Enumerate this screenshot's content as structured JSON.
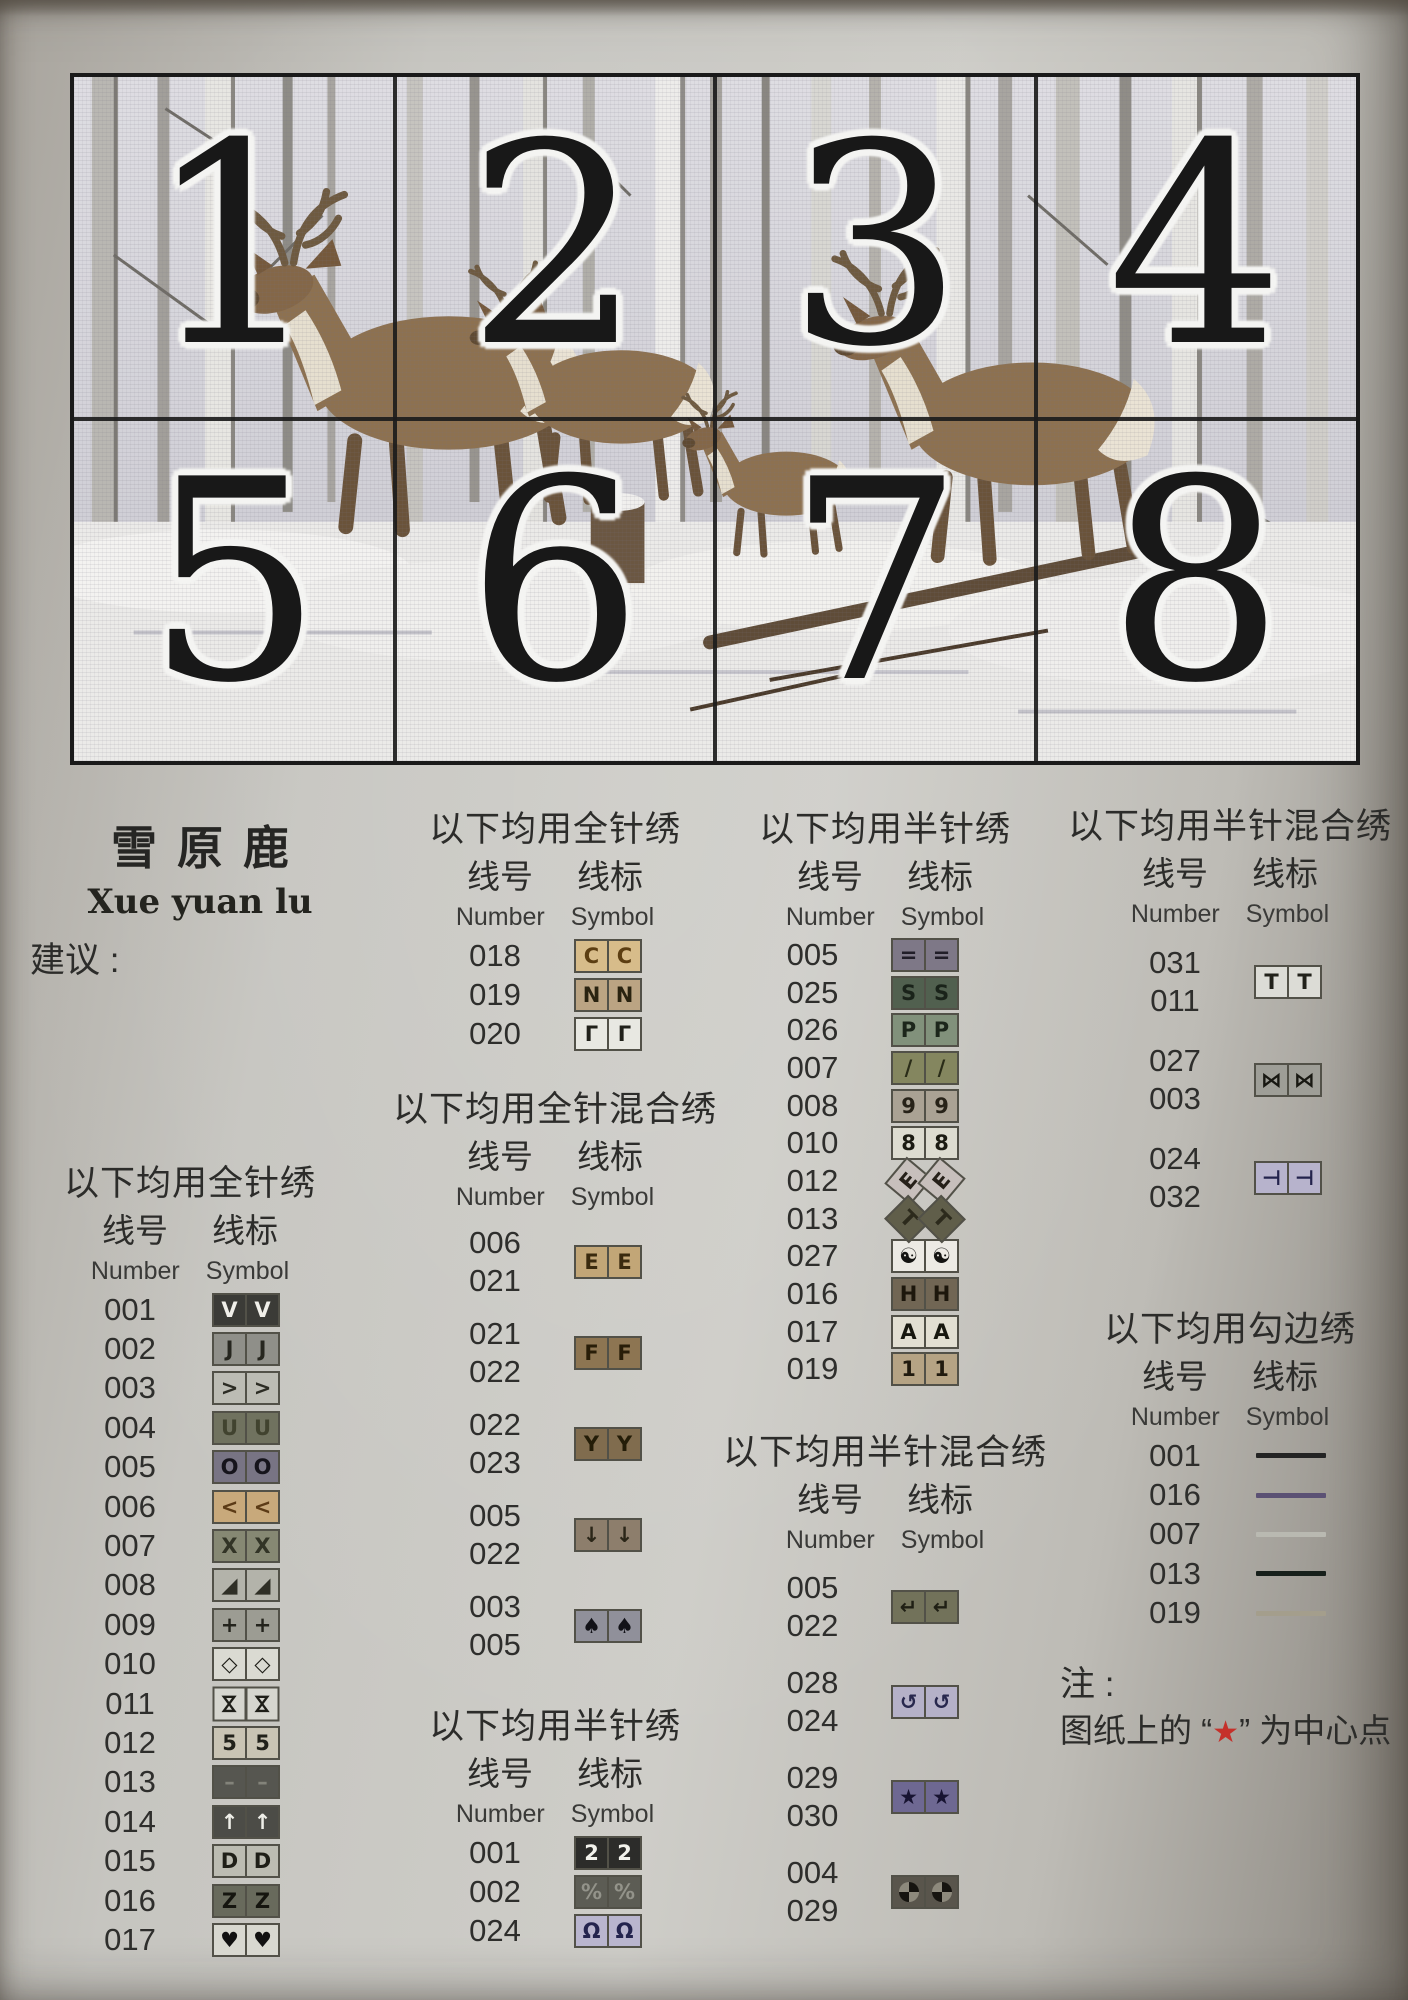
{
  "pattern_preview": {
    "section_numbers": [
      "1",
      "2",
      "3",
      "4",
      "5",
      "6",
      "7",
      "8"
    ]
  },
  "title": {
    "chinese": "雪原鹿",
    "pinyin": "Xue yuan lu"
  },
  "suggestions": {
    "heading": "建议 :",
    "lines": [
      "9CT 大格布用 4 股线绣",
      "11CT 中格布用 3 股线绣",
      "14CT 小格布用 2 股线绣"
    ]
  },
  "col_labels": {
    "cn_number": "线号",
    "cn_symbol": "线标",
    "en_number": "Number",
    "en_symbol": "Symbol"
  },
  "section_titles": {
    "full": "以下均用全针绣",
    "full_mix": "以下均用全针混合绣",
    "half": "以下均用半针绣",
    "half_mix": "以下均用半针混合绣",
    "outline": "以下均用勾边绣"
  },
  "legend": {
    "full_col1": [
      {
        "num": "001",
        "sym": "V",
        "bg": "#3b3b37",
        "fg": "#f0efe9"
      },
      {
        "num": "002",
        "sym": "J",
        "bg": "#8f8f89",
        "fg": "#26261f"
      },
      {
        "num": "003",
        "sym": ">",
        "bg": "#bcbcb4",
        "fg": "#2c2c24"
      },
      {
        "num": "004",
        "sym": "U",
        "bg": "#70725f",
        "fg": "#41432f"
      },
      {
        "num": "005",
        "sym": "O",
        "bg": "#787484",
        "fg": "#16141c"
      },
      {
        "num": "006",
        "sym": "<",
        "bg": "#c8a97b",
        "fg": "#5c3b16"
      },
      {
        "num": "007",
        "sym": "X",
        "bg": "#868873",
        "fg": "#323426"
      },
      {
        "num": "008",
        "sym": "◢",
        "bg": "#b3b3aa",
        "fg": "#2f2f26"
      },
      {
        "num": "009",
        "sym": "+",
        "bg": "#9c9c93",
        "fg": "#24241d"
      },
      {
        "num": "010",
        "sym": "◇",
        "bg": "#dadad2",
        "fg": "#1c1c16"
      },
      {
        "num": "011",
        "sym": "⋈",
        "rot": 90,
        "bg": "#d6d6cf",
        "fg": "#1e1e18"
      },
      {
        "num": "012",
        "sym": "5",
        "bg": "#c9c4b4",
        "fg": "#21211a"
      },
      {
        "num": "013",
        "sym": "–",
        "bg": "#565650",
        "fg": "#83837a"
      },
      {
        "num": "014",
        "sym": "↑",
        "bg": "#4c4c47",
        "fg": "#eeeee8"
      },
      {
        "num": "015",
        "sym": "D",
        "bg": "#bcbcb2",
        "fg": "#1f1f18"
      },
      {
        "num": "016",
        "sym": "Z",
        "bg": "#686a5c",
        "fg": "#15150f"
      },
      {
        "num": "017",
        "sym": "♥",
        "bg": "#d8d8d0",
        "fg": "#111111"
      }
    ],
    "full_col2": [
      {
        "num": "018",
        "sym": "C",
        "bg": "#d7bc8a",
        "fg": "#5c3e12"
      },
      {
        "num": "019",
        "sym": "N",
        "bg": "#bba483",
        "fg": "#2a2310"
      },
      {
        "num": "020",
        "sym": "Γ",
        "bg": "#e8e8e2",
        "fg": "#20201a"
      }
    ],
    "full_mix": [
      {
        "nums": [
          "006",
          "021"
        ],
        "sym": "E",
        "bg": "#c2a677",
        "fg": "#3a2a0e"
      },
      {
        "nums": [
          "021",
          "022"
        ],
        "sym": "F",
        "bg": "#8d7552",
        "fg": "#281d08"
      },
      {
        "nums": [
          "022",
          "023"
        ],
        "sym": "Y",
        "bg": "#806c4e",
        "fg": "#241d08"
      },
      {
        "nums": [
          "005",
          "022"
        ],
        "sym": "↓",
        "bg": "#8d7e6c",
        "fg": "#2b2618"
      },
      {
        "nums": [
          "003",
          "005"
        ],
        "sym": "♠",
        "bg": "#90909a",
        "fg": "#121218"
      }
    ],
    "half_col2": [
      {
        "num": "001",
        "sym": "2",
        "bg": "#2c2c2a",
        "fg": "#f2f2ec"
      },
      {
        "num": "002",
        "sym": "%",
        "bg": "#5c5c54",
        "fg": "#93938a"
      },
      {
        "num": "024",
        "sym": "Ω",
        "bg": "#b9b5ce",
        "fg": "#24244e"
      }
    ],
    "half_col3": [
      {
        "num": "005",
        "sym": "=",
        "bg": "#7e7887",
        "fg": "#211e28"
      },
      {
        "num": "025",
        "sym": "S",
        "bg": "#51604f",
        "fg": "#1a231a"
      },
      {
        "num": "026",
        "sym": "P",
        "bg": "#81917b",
        "fg": "#1c261b"
      },
      {
        "num": "007",
        "sym": "/",
        "bg": "#84865f",
        "fg": "#2a2c18"
      },
      {
        "num": "008",
        "sym": "9",
        "bg": "#aaa294",
        "fg": "#272218"
      },
      {
        "num": "010",
        "sym": "8",
        "bg": "#dddcd0",
        "fg": "#1b1b12"
      },
      {
        "num": "012",
        "sym": "E",
        "rot": -50,
        "bg": "#c7bfbc",
        "fg": "#262019"
      },
      {
        "num": "013",
        "sym": "T",
        "rot": 45,
        "bg": "#605e4a",
        "fg": "#2c2a1c"
      },
      {
        "num": "027",
        "sym": "☯",
        "bg": "#eceae4",
        "fg": "#141412"
      },
      {
        "num": "016",
        "sym": "H",
        "bg": "#716654",
        "fg": "#1d170c"
      },
      {
        "num": "017",
        "sym": "A",
        "bg": "#e2dfd2",
        "fg": "#17170f"
      },
      {
        "num": "019",
        "sym": "1",
        "bg": "#b5a384",
        "fg": "#201a0e"
      }
    ],
    "half_mix_col3": [
      {
        "nums": [
          "005",
          "022"
        ],
        "sym": "↵",
        "bg": "#72725a",
        "fg": "#1f1f14"
      },
      {
        "nums": [
          "028",
          "024"
        ],
        "sym": "↺",
        "bg": "#b5b1c8",
        "fg": "#28284e"
      },
      {
        "nums": [
          "029",
          "030"
        ],
        "sym": "★",
        "bg": "#6e6892",
        "fg": "#181432"
      },
      {
        "nums": [
          "004",
          "029"
        ],
        "type": "pie",
        "bg": "#59554c",
        "fg": "#161410",
        "alt": "#8d897c"
      }
    ],
    "half_mix_col4": [
      {
        "nums": [
          "031",
          "011"
        ],
        "sym": "T",
        "bg": "#dcdcd6",
        "fg": "#21211a"
      },
      {
        "nums": [
          "027",
          "003"
        ],
        "sym": "⋈",
        "bg": "#9e9e97",
        "fg": "#181812"
      },
      {
        "nums": [
          "024",
          "032"
        ],
        "sym": "⊣",
        "bg": "#b7b3cc",
        "fg": "#23234c"
      }
    ],
    "outline": [
      {
        "num": "001",
        "color": "#242424"
      },
      {
        "num": "016",
        "color": "#5b5174"
      },
      {
        "num": "007",
        "color": "#b9b9b1"
      },
      {
        "num": "013",
        "color": "#17201b"
      },
      {
        "num": "019",
        "color": "#a49e8c"
      }
    ]
  },
  "note": {
    "heading": "注 :",
    "before": "图纸上的 “",
    "star": "★",
    "after": "” 为中心点",
    "star_color": "#c5302a"
  }
}
